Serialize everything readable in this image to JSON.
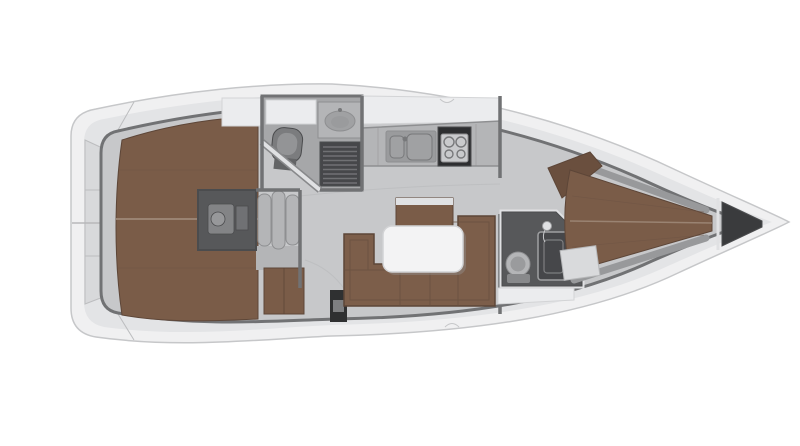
{
  "canvas": {
    "width": 800,
    "height": 446,
    "background": "#ffffff"
  },
  "colors": {
    "background": "#ffffff",
    "hull": "#f0f0f1",
    "hullEdge": "#c6c7c9",
    "deck": "#e3e4e6",
    "deckPanel": "#d8d9db",
    "deckShadow": "#bcbdbf",
    "hatch": "#f4f4f5",
    "hatchEdge": "#d8d9db",
    "floor": "#c7c8ca",
    "floorSeam": "#b7b8ba",
    "floorDark": "#a6a7a9",
    "wall": "#717274",
    "wallDark": "#4b4c4e",
    "wallLight": "#e0e1e3",
    "wallCasing": "#88898b",
    "wood": "#7a5c48",
    "woodDark": "#5d4638",
    "woodSeam": "#9a8372",
    "woodPlank": "#6e5445",
    "woodHeadboard": "#6a4f3e",
    "cushion": "#7c5e4a",
    "cushionSeam": "#67503f",
    "white": "#ebecee",
    "whiteEdge": "#d3d4d6",
    "table": "#f3f3f4",
    "tableEdge": "#d2d3d5",
    "tableShadow": "#9a9b9d",
    "fixture": "#b4b5b7",
    "fixtureDark": "#8e8f91",
    "fixtureInner": "#9a9b9d",
    "basin": "#a0a1a3",
    "steel": "#9fa0a2",
    "grate": "#46474a",
    "grateSlat": "#707174",
    "stove": "#2d2e30",
    "stovePanel": "#c9cacc",
    "burner": "#77787a",
    "engine": "#57585a",
    "engineDetail": "#838486",
    "engineLight": "#97989a",
    "toilet": "#7b7c7e",
    "toiletSeat": "#939496",
    "toiletTank": "#636466",
    "locker": "#3a3b3d",
    "shelf": "#98999b",
    "seat": "#d9dadc",
    "seatEdge": "#b6b7b9",
    "post": "#2f3031",
    "postPanel": "#7e7f81",
    "cleat": "#6b6c6e"
  },
  "regions": {
    "plan": "Sailing yacht interior layout — deck plan, bow to the right",
    "hull": "Hull and side decks",
    "stern": "Stern transom lockers",
    "aft_cabin": "Aft double berth cabin",
    "companionway": "Companionway steps",
    "engine": "Engine compartment",
    "aft_head": "Aft head: WC, washbasin, shower",
    "galley": "Galley: double sink and stove",
    "salon": "Salon: U-shaped settee, table, sideboard",
    "fwd_head": "Forward head: WC and shower",
    "fwd_cabin": "Forward V-berth cabin",
    "anchor_locker": "Anchor locker"
  }
}
